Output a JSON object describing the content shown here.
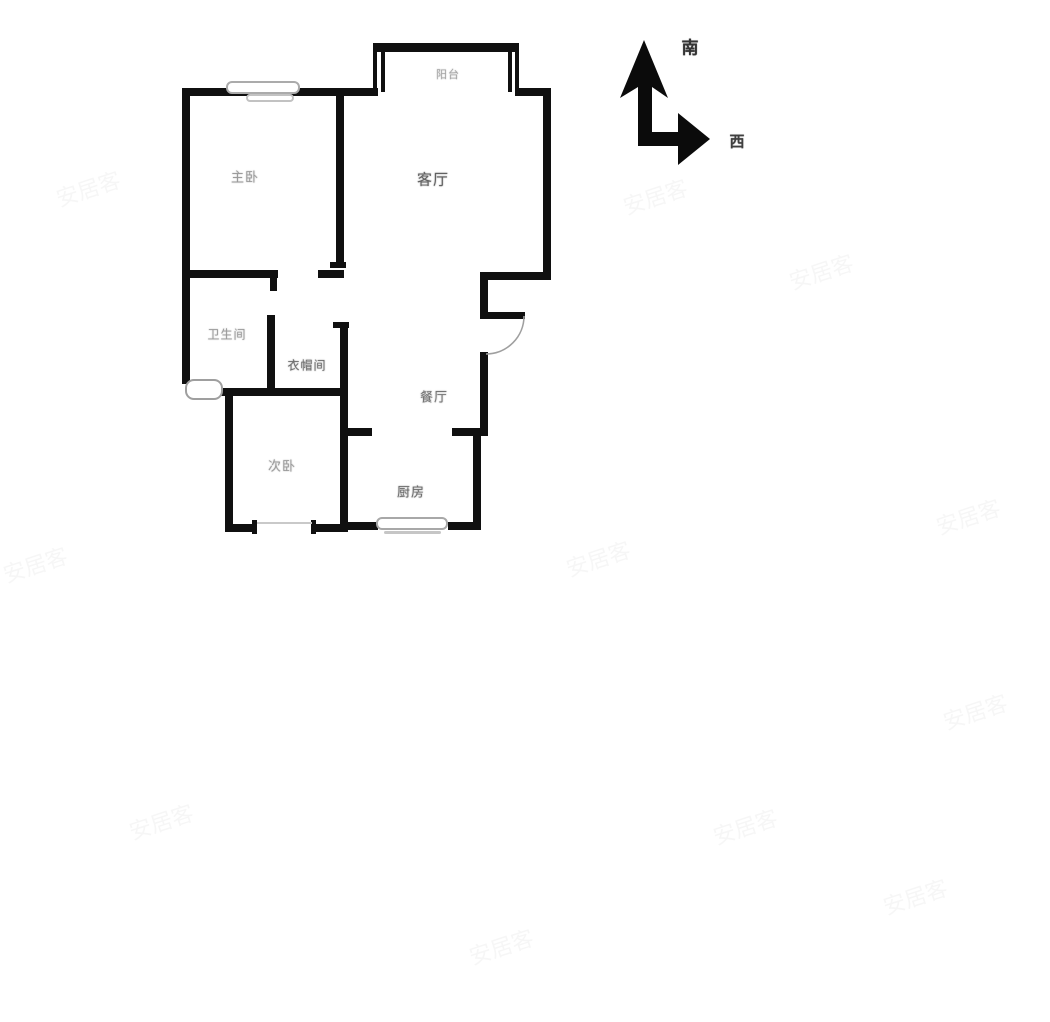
{
  "title": "户型图",
  "compass": {
    "up_label": "南",
    "right_label": "西"
  },
  "rooms": [
    {
      "id": "balcony",
      "label": "阳台"
    },
    {
      "id": "living-room",
      "label": "客厅"
    },
    {
      "id": "master-bedroom",
      "label": "主卧"
    },
    {
      "id": "bathroom",
      "label": "卫生间"
    },
    {
      "id": "cloakroom",
      "label": "衣帽间"
    },
    {
      "id": "dining-room",
      "label": "餐厅"
    },
    {
      "id": "second-bedroom",
      "label": "次卧"
    },
    {
      "id": "kitchen",
      "label": "厨房"
    }
  ],
  "watermark": "安居客",
  "colors": {
    "wall": "#101010",
    "window": "#ababab",
    "door_arc": "#9f9f9f",
    "label": "#3a3a3a",
    "background": "#ffffff"
  }
}
